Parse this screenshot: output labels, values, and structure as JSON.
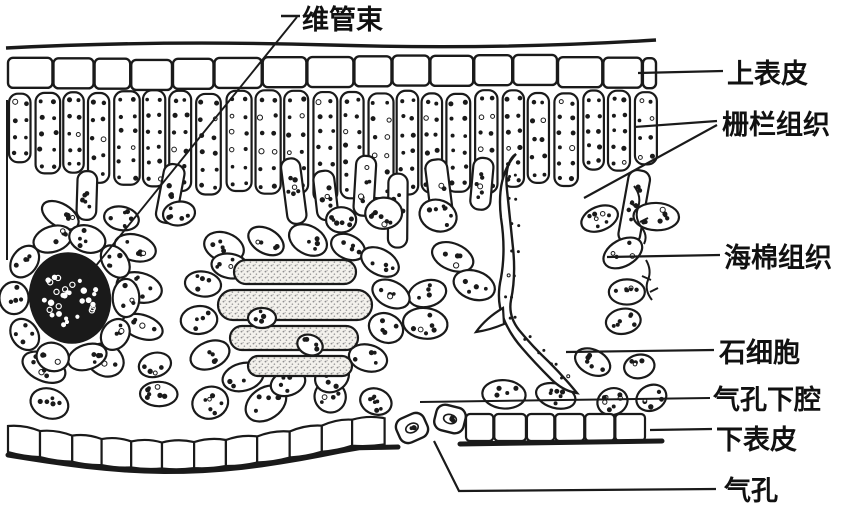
{
  "figure": {
    "kind": "leaf cross-section biological illustration",
    "background_color": "#ffffff",
    "ink_color": "#1a1a1a"
  },
  "labels": {
    "vascular_bundle": "维管束",
    "upper_epidermis": "上表皮",
    "palisade_tissue": "栅栏组织",
    "spongy_tissue": "海棉组织",
    "stone_cell": "石细胞",
    "substomatal_cavity": "气孔下腔",
    "lower_epidermis": "下表皮",
    "stoma": "气孔"
  }
}
